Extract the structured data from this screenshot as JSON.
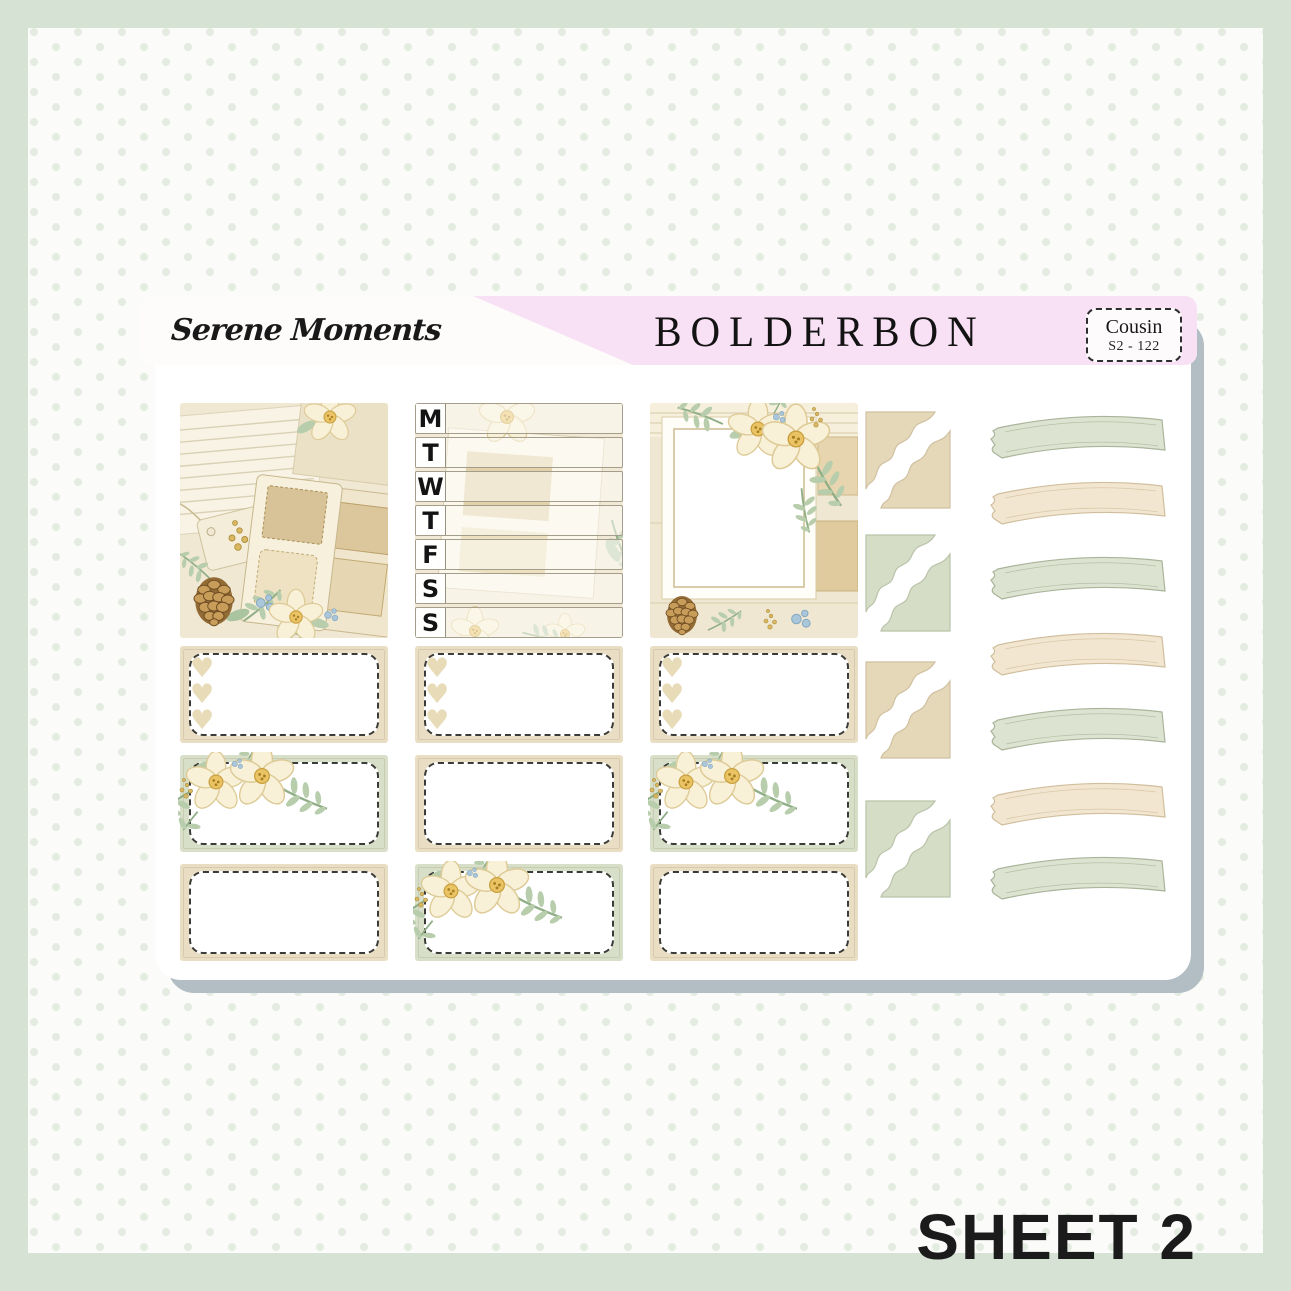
{
  "page": {
    "background_frame_color": "#d6e3d4",
    "canvas_color": "#fbfcf9",
    "dot_color": "#e4ece2",
    "sheet_shadow_color": "#b2bec4"
  },
  "header": {
    "collection_title": "Serene Moments",
    "brand": "BOLDERBON",
    "band_pink": "#f8e1f5",
    "size_tag": {
      "line1": "Cousin",
      "line2": "S2 - 122"
    }
  },
  "footer": {
    "sheet_label": "SHEET 2"
  },
  "planner": {
    "weekday_letters": [
      "M",
      "T",
      "W",
      "T",
      "F",
      "S",
      "S"
    ]
  },
  "palette": {
    "tan_box": "#e9ddc4",
    "sage_box": "#d8dfc9",
    "dash_border": "#3b3b37",
    "heart": "#e8dbb8",
    "corner_tan_fill": "#e5d8b9",
    "corner_tan_stroke": "#cfc0a0",
    "corner_sage_fill": "#d6ddc7",
    "corner_sage_stroke": "#b9c3a9",
    "washi_sage_fill": "#dde3d1",
    "washi_sage_stroke": "#aab49b",
    "washi_tan_fill": "#f2e6d0",
    "washi_tan_stroke": "#d0bf9e"
  },
  "stickers": {
    "full_boxes": [
      {
        "name": "scrapbook-scene-box"
      },
      {
        "name": "weekly-date-cover-box"
      },
      {
        "name": "photo-frame-box"
      }
    ],
    "half_boxes": {
      "rows": [
        [
          {
            "color": "tan",
            "decor": "hearts"
          },
          {
            "color": "tan",
            "decor": "hearts"
          },
          {
            "color": "tan",
            "decor": "hearts"
          }
        ],
        [
          {
            "color": "sage",
            "decor": "flowers"
          },
          {
            "color": "tan",
            "decor": "plain"
          },
          {
            "color": "sage",
            "decor": "flowers"
          }
        ],
        [
          {
            "color": "tan",
            "decor": "plain"
          },
          {
            "color": "sage",
            "decor": "flowers"
          },
          {
            "color": "tan",
            "decor": "plain"
          }
        ]
      ]
    },
    "corner_stickers": {
      "colors": [
        "tan",
        "sage",
        "tan",
        "sage"
      ]
    },
    "washi_strips": {
      "colors": [
        "sage",
        "tan",
        "sage",
        "tan",
        "sage",
        "tan",
        "sage"
      ]
    }
  }
}
